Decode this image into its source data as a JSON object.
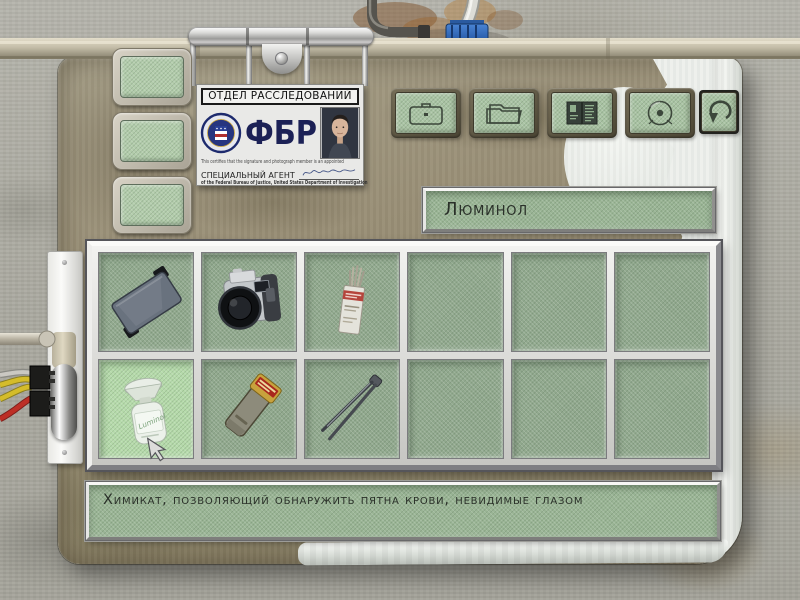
{
  "id_card": {
    "title": "ОТДЕЛ РАССЛЕДОВАНИЙ",
    "agency": "ФБР",
    "certify_text": "This certifies that the signature and photograph member is an appointed",
    "agent_label": "СПЕЦИАЛЬНЫЙ АГЕНТ",
    "footer_text": "of the Federal Bureau of Justice, United States Department of Investigation"
  },
  "toolbar": {
    "buttons": [
      {
        "name": "briefcase-button",
        "icon": "briefcase-icon"
      },
      {
        "name": "folder-button",
        "icon": "folder-icon"
      },
      {
        "name": "casebook-button",
        "icon": "open-book-icon"
      },
      {
        "name": "disc-button",
        "icon": "disc-icon"
      },
      {
        "name": "back-button",
        "icon": "back-arrow-icon"
      }
    ]
  },
  "side_buttons": [
    {
      "index": 1,
      "state": "empty"
    },
    {
      "index": 2,
      "state": "empty"
    },
    {
      "index": 3,
      "state": "empty"
    }
  ],
  "item_panel": {
    "name": "Люминол",
    "description": "Химикат, позволяющий обнаружить пятна крови, невидимые глазом"
  },
  "inventory": {
    "rows": 2,
    "cols": 6,
    "selected_slot": 7,
    "slots": [
      {
        "index": 1,
        "item": "equipment-case"
      },
      {
        "index": 2,
        "item": "photo-camera"
      },
      {
        "index": 3,
        "item": "swab-pack"
      },
      {
        "index": 4,
        "item": null
      },
      {
        "index": 5,
        "item": null
      },
      {
        "index": 6,
        "item": null
      },
      {
        "index": 7,
        "item": "luminol-spray-bottle",
        "label": "Luminol",
        "selected": true
      },
      {
        "index": 8,
        "item": "uv-lamp"
      },
      {
        "index": 9,
        "item": "tweezers"
      },
      {
        "index": 10,
        "item": null
      },
      {
        "index": 11,
        "item": null
      },
      {
        "index": 12,
        "item": null
      }
    ]
  },
  "colors": {
    "slot_green": "#91a98e",
    "slot_selected": "#b5daaa",
    "button_green": "#a9c3a3",
    "panel_grunge": "#968d74",
    "panel_plastic": "#edf0ec",
    "valve_blue": "#2d62b0",
    "wire_yellow": "#d4bc2a",
    "wire_red": "#bd2f26"
  }
}
